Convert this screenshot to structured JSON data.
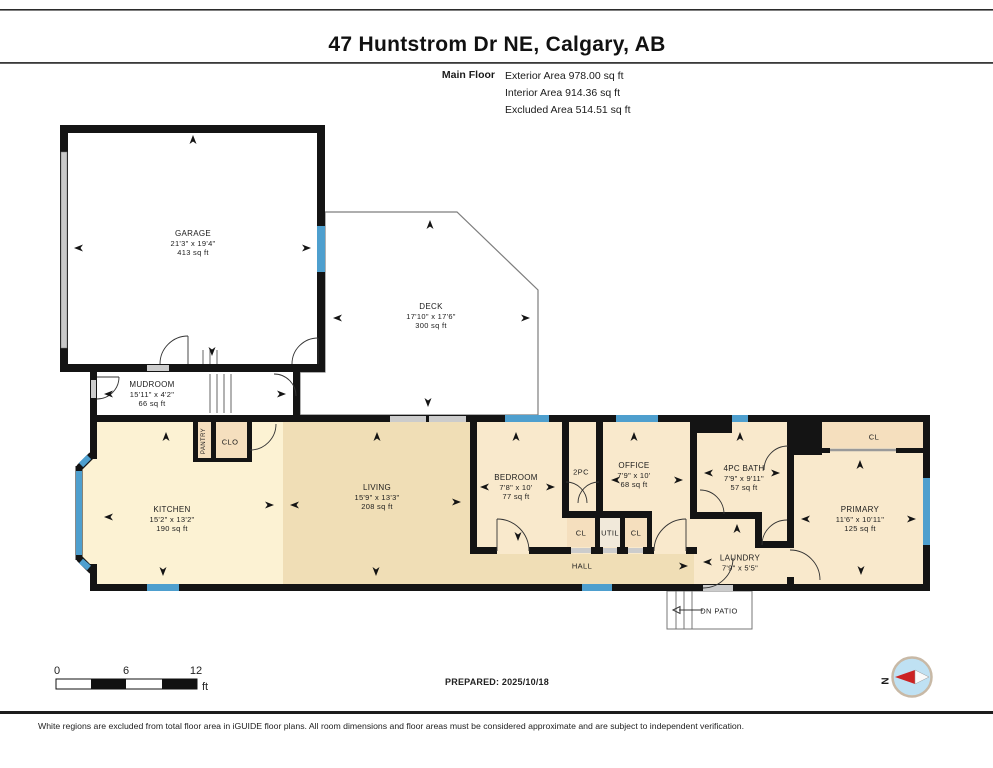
{
  "header": {
    "title": "47 Huntstrom Dr NE, Calgary, AB",
    "floor_label": "Main Floor",
    "areas": [
      "Exterior Area 978.00 sq ft",
      "Interior Area 914.36 sq ft",
      "Excluded Area 514.51 sq ft"
    ]
  },
  "rooms": {
    "garage": {
      "name": "GARAGE",
      "dims": "21'3\" x 19'4\"",
      "area": "413 sq ft"
    },
    "deck": {
      "name": "DECK",
      "dims": "17'10\" x 17'6\"",
      "area": "300 sq ft"
    },
    "mudroom": {
      "name": "MUDROOM",
      "dims": "15'11\" x 4'2\"",
      "area": "66 sq ft"
    },
    "kitchen": {
      "name": "KITCHEN",
      "dims": "15'2\" x 13'2\"",
      "area": "190 sq ft"
    },
    "living": {
      "name": "LIVING",
      "dims": "15'9\" x 13'3\"",
      "area": "208 sq ft"
    },
    "bedroom": {
      "name": "BEDROOM",
      "dims": "7'8\" x 10'",
      "area": "77 sq ft"
    },
    "two_pc": {
      "name": "2PC"
    },
    "office": {
      "name": "OFFICE",
      "dims": "7'9\" x 10'",
      "area": "68 sq ft"
    },
    "bath": {
      "name": "4PC BATH",
      "dims": "7'9\" x 9'11\"",
      "area": "57 sq ft"
    },
    "primary": {
      "name": "PRIMARY",
      "dims": "11'6\" x 10'11\"",
      "area": "125 sq ft"
    },
    "laundry": {
      "name": "LAUNDRY",
      "dims": "7'9\" x 5'5\""
    },
    "hall": {
      "name": "HALL"
    },
    "pantry": {
      "name": "PANTRY"
    },
    "clo": {
      "name": "CLO"
    },
    "cl1": {
      "name": "CL"
    },
    "util": {
      "name": "UTIL"
    },
    "cl2": {
      "name": "CL"
    },
    "primary_closet": {
      "name": "CL"
    },
    "patio": {
      "name": "DN  PATIO"
    }
  },
  "scale_bar": {
    "t0": "0",
    "t6": "6",
    "t12": "12",
    "unit": "ft"
  },
  "compass": {
    "label": "N"
  },
  "footer": {
    "prepared": "PREPARED: 2025/10/18",
    "disclaimer": "White regions are excluded from total floor area in iGUIDE floor plans. All room dimensions and floor areas must be considered approximate and are subject to independent verification."
  },
  "colors": {
    "wall_black": "#141414",
    "window_blue": "#4E9FCE",
    "kitchen_fill": "#FCF2D3",
    "living_fill": "#F0DEB6",
    "room_fill": "#F9E9CC",
    "closet_fill": "#F5DFBE",
    "door_gray": "#CCCCCC",
    "compass_blue": "#BFE1F3",
    "compass_red": "#CC2222"
  }
}
